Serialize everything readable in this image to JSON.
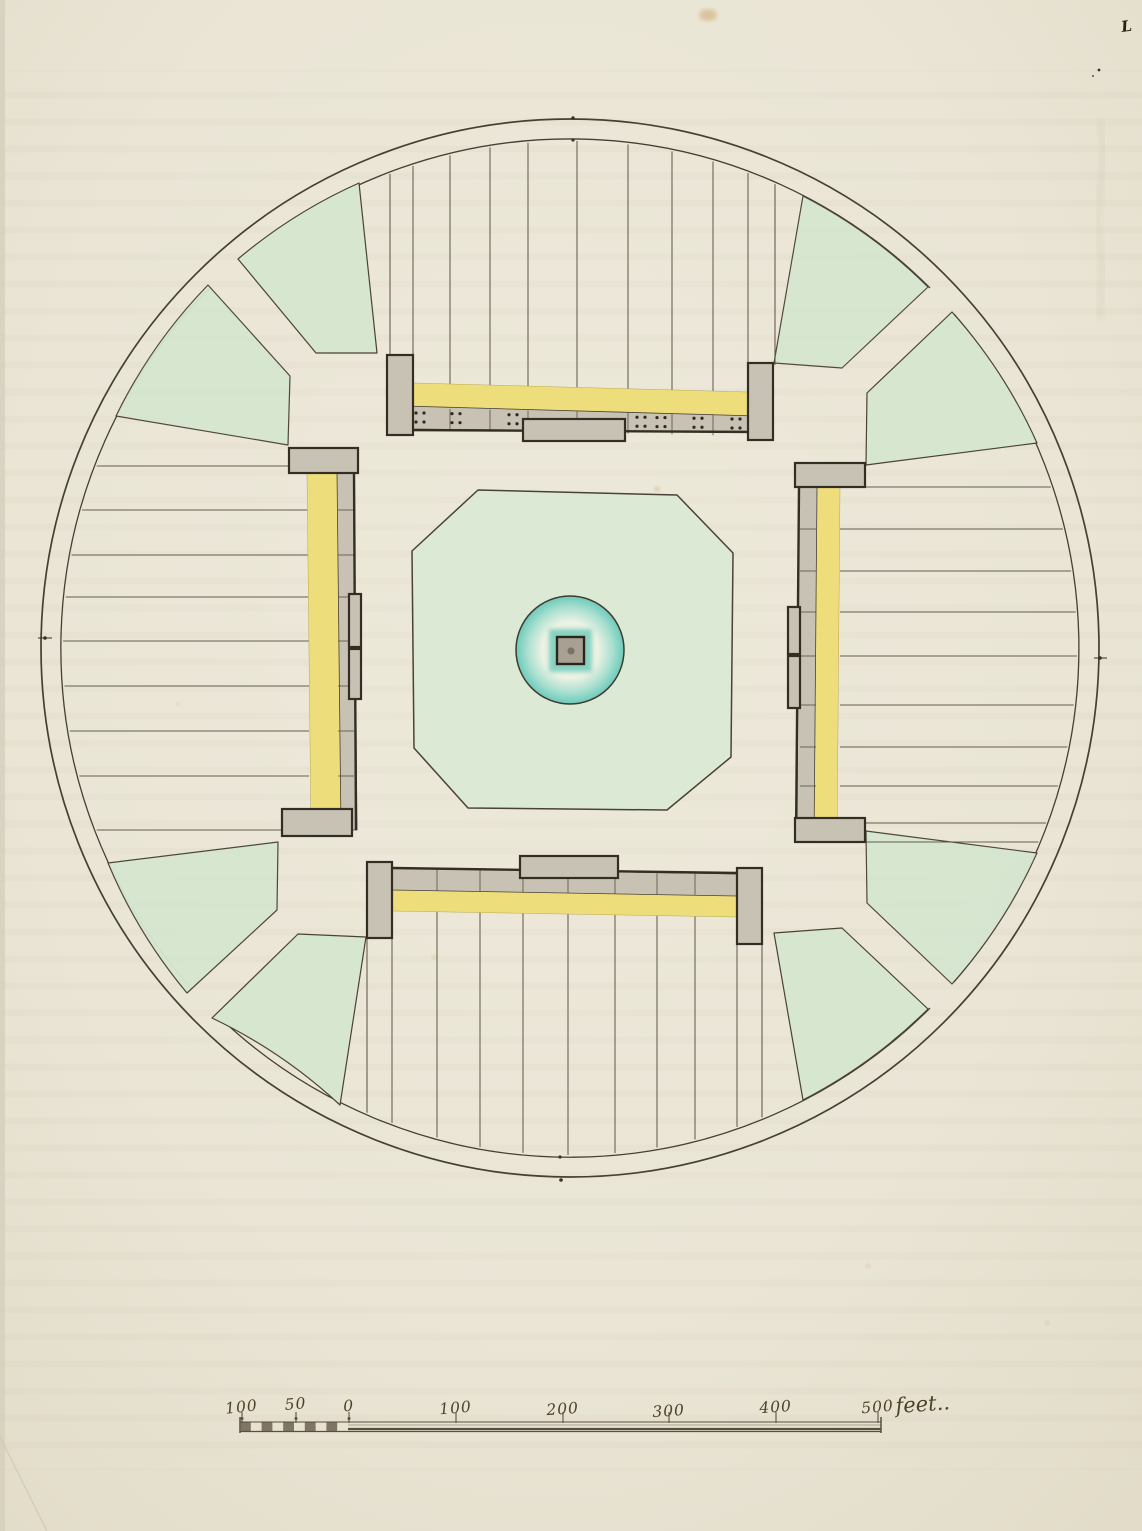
{
  "document": {
    "kind_note": "hand-drawn circular plan with central court, scale bar below",
    "corner_mark": "L"
  },
  "scale": {
    "labels": [
      "100",
      "50",
      "0",
      "100",
      "200",
      "300",
      "400",
      "500"
    ],
    "unit": "feet.."
  },
  "colors": {
    "paper": "#eae5d5",
    "paper_edge": "#e1dbc7",
    "ink": "#4a4236",
    "ink_dark": "#2f2a20",
    "green": "#d6e6cf",
    "octagon_green": "#dcead5",
    "teal": "#74ccbc",
    "yellow": "#eedd7b",
    "gray": "#c8c2b5",
    "pier_outline": "#332d23",
    "scale_ink": "#57503f"
  }
}
